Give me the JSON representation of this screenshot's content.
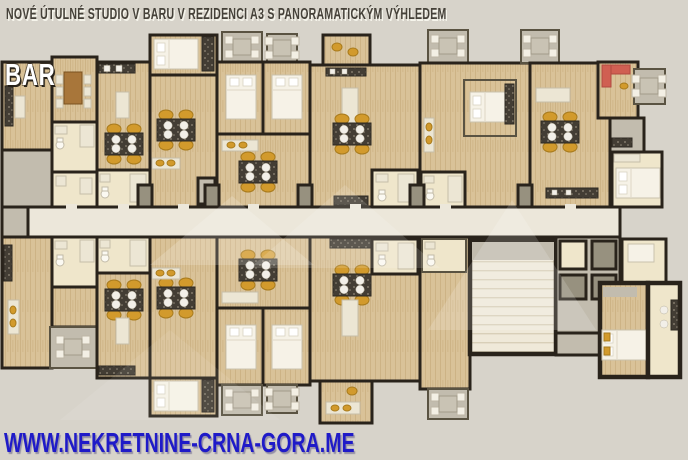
{
  "header": {
    "title": "NOVÉ ÚTULNÉ STUDIO V BARU V REZIDENCI A3 S PANORAMATICKÝM VÝHLEDEM"
  },
  "plan": {
    "location_label": "BAR"
  },
  "footer": {
    "website": "WWW.NEKRETNINE-CRNA-GORA.ME"
  },
  "colors": {
    "background": "#d7d3ca",
    "wall": "#29231b",
    "wood_floor": "#d9c298",
    "wood_plank_line": "#c3a775",
    "tile_floor": "#efe9d9",
    "cream_floor": "#efe6cb",
    "gray_floor": "#c2bcae",
    "dark_gray_floor": "#97917f",
    "corridor_floor": "#ece7da",
    "chair_gold": "#d29a2c",
    "table_dark": "#433d34",
    "plate_white": "#f2efe8",
    "bed_white": "#f6f2e7",
    "sofa_red": "#d05f52",
    "title_text": "#454139",
    "label_text": "#ffffff",
    "website_text": "#1f1ac8"
  }
}
